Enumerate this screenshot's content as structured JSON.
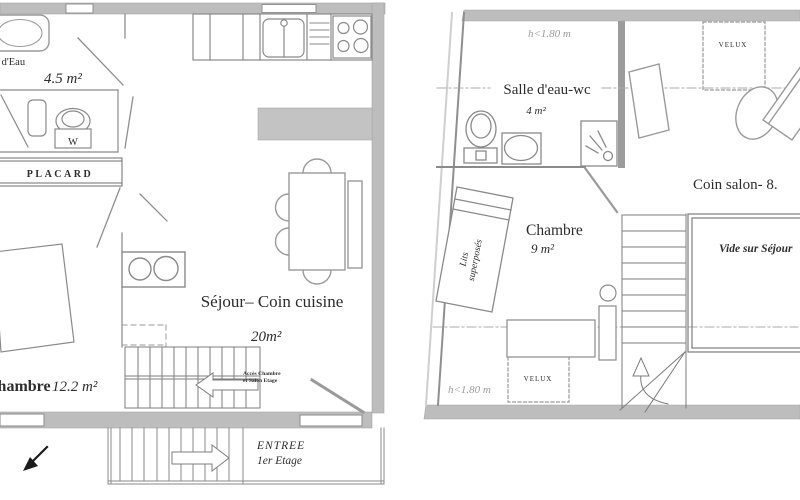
{
  "left_plan": {
    "bathroom_label": "Salle d'Eau",
    "bathroom_area": "4.5 m²",
    "wc_label": "W",
    "closet_label": "PLACARD",
    "living_label": "Séjour– Coin cuisine",
    "living_area": "20m²",
    "stairs_note_line1": "Accès Chambre",
    "stairs_note_line2": "et Salon Etage",
    "bedroom_label": "Chambre",
    "bedroom_area": "12.2 m²",
    "entrance_line1": "ENTREE",
    "entrance_line2": "1er Etage"
  },
  "right_plan": {
    "height_note_top": "h<1.80 m",
    "height_note_bottom": "h<1.80 m",
    "velux_top_label": "VELUX",
    "velux_bottom_label": "VELUX",
    "bathroom_label": "Salle d'eau-wc",
    "bathroom_area": "4 m²",
    "bedroom_label": "Chambre",
    "bedroom_area": "9 m²",
    "bunk_bed_line1": "Lits",
    "bunk_bed_line2": "superposés",
    "salon_label": "Coin salon- 8.",
    "void_label": "Vide sur Séjour"
  },
  "colors": {
    "wall_gray": "#bdbdbd",
    "wall_dark": "#9c9c9c",
    "line_gray": "#8a8a8a",
    "text_dark": "#2d2d2d",
    "note_gray": "#9b9b9b",
    "background": "#ffffff"
  }
}
